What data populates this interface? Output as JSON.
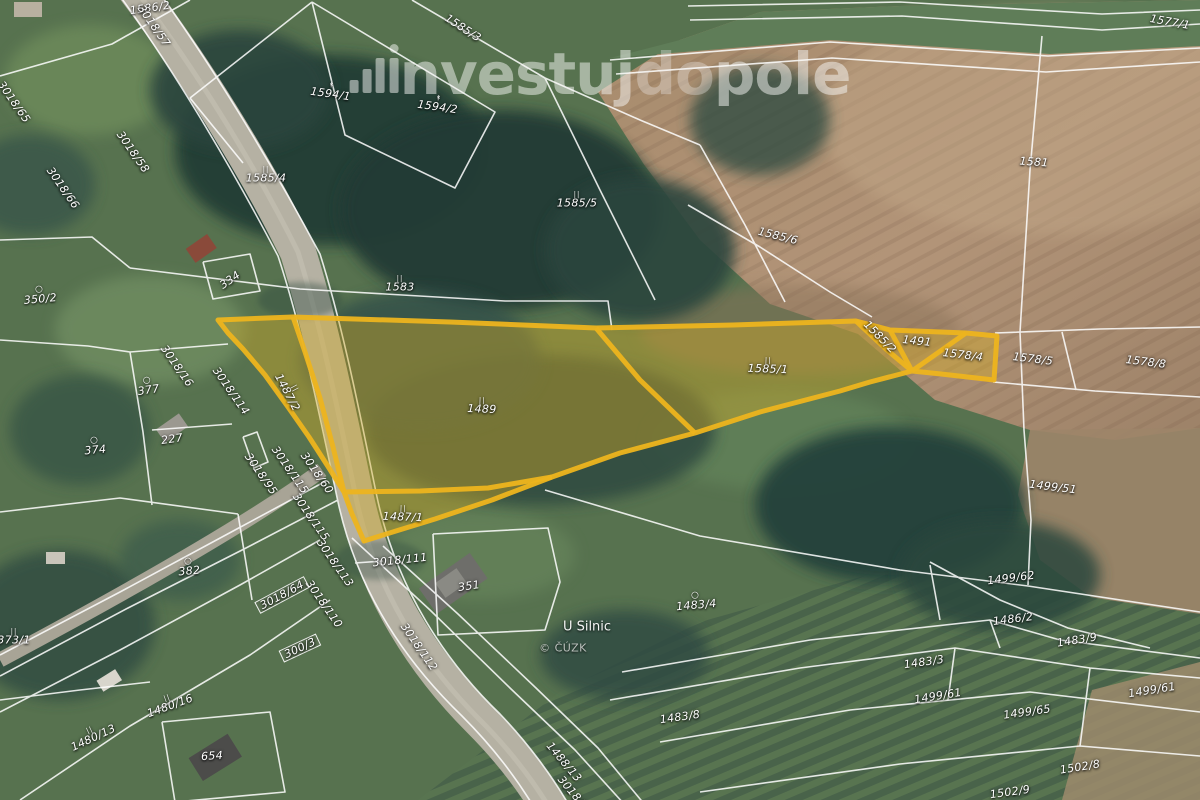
{
  "watermark": {
    "icon": "bar-chart-logo",
    "text_investuj": "nvestuj",
    "text_do": "do",
    "text_pole": "pole"
  },
  "map": {
    "place_label": "U Silnic",
    "copyright": "© ČÚZK",
    "highlight": {
      "color": "#edb41e",
      "parcels": [
        "1487/1",
        "1487/2",
        "1489",
        "1585/1",
        "1585/2",
        "1491",
        "1578/4"
      ]
    },
    "parcel_labels": [
      {
        "text": "1586/2",
        "x": 150,
        "y": 8,
        "rot": -8
      },
      {
        "text": "1585/3",
        "x": 463,
        "y": 28,
        "rot": 33
      },
      {
        "text": "1577/1",
        "x": 1170,
        "y": 22,
        "rot": 10
      },
      {
        "text": "1594/1",
        "x": 331,
        "y": 91,
        "rot": 8,
        "sym": "tree"
      },
      {
        "text": "1594/2",
        "x": 438,
        "y": 104,
        "rot": 8,
        "sym": "tree"
      },
      {
        "text": "3018/57",
        "x": 154,
        "y": 26,
        "rot": 55
      },
      {
        "text": "3018/58",
        "x": 133,
        "y": 152,
        "rot": 55
      },
      {
        "text": "3018/66",
        "x": 63,
        "y": 188,
        "rot": 55
      },
      {
        "text": "3018/65",
        "x": 14,
        "y": 102,
        "rot": 55
      },
      {
        "text": "1585/4",
        "x": 266,
        "y": 175,
        "rot": 0,
        "sym": "ii"
      },
      {
        "text": "1585/5",
        "x": 577,
        "y": 200,
        "rot": 0,
        "sym": "ii"
      },
      {
        "text": "1583",
        "x": 400,
        "y": 284,
        "rot": 0,
        "sym": "ii"
      },
      {
        "text": "1585/6",
        "x": 778,
        "y": 236,
        "rot": 14
      },
      {
        "text": "1581",
        "x": 1034,
        "y": 162,
        "rot": 4
      },
      {
        "text": "334",
        "x": 230,
        "y": 280,
        "rot": -35
      },
      {
        "text": "350/2",
        "x": 40,
        "y": 295,
        "rot": -5,
        "sym": "circle"
      },
      {
        "text": "377",
        "x": 148,
        "y": 386,
        "rot": -8,
        "sym": "circle"
      },
      {
        "text": "374",
        "x": 95,
        "y": 446,
        "rot": -5,
        "sym": "circle"
      },
      {
        "text": "227",
        "x": 172,
        "y": 439,
        "rot": -8
      },
      {
        "text": "382",
        "x": 189,
        "y": 567,
        "rot": -5,
        "sym": "circle"
      },
      {
        "text": "373/1",
        "x": 14,
        "y": 637,
        "rot": 0,
        "sym": "ii"
      },
      {
        "text": "3018/16",
        "x": 177,
        "y": 366,
        "rot": 55
      },
      {
        "text": "3018/114",
        "x": 231,
        "y": 391,
        "rot": 55
      },
      {
        "text": "1487/2",
        "x": 290,
        "y": 391,
        "rot": 62,
        "sym": "ii"
      },
      {
        "text": "3018/95",
        "x": 261,
        "y": 474,
        "rot": 55
      },
      {
        "text": "3018/115",
        "x": 290,
        "y": 470,
        "rot": 55
      },
      {
        "text": "3018/60",
        "x": 317,
        "y": 473,
        "rot": 55
      },
      {
        "text": "3018/115",
        "x": 311,
        "y": 517,
        "rot": 55
      },
      {
        "text": "3018/113",
        "x": 335,
        "y": 563,
        "rot": 55
      },
      {
        "text": "3018/110",
        "x": 324,
        "y": 604,
        "rot": 55
      },
      {
        "text": "3018/64",
        "x": 282,
        "y": 595,
        "rot": -28,
        "boxed": true
      },
      {
        "text": "300/3",
        "x": 300,
        "y": 648,
        "rot": -25,
        "boxed": true
      },
      {
        "text": "3018/111",
        "x": 400,
        "y": 560,
        "rot": -6
      },
      {
        "text": "3018/112",
        "x": 419,
        "y": 647,
        "rot": 55
      },
      {
        "text": "1489",
        "x": 482,
        "y": 406,
        "rot": 2,
        "sym": "ii"
      },
      {
        "text": "1487/1",
        "x": 403,
        "y": 514,
        "rot": 2,
        "sym": "ii"
      },
      {
        "text": "1585/1",
        "x": 768,
        "y": 366,
        "rot": 2,
        "sym": "ii"
      },
      {
        "text": "1585/2",
        "x": 880,
        "y": 337,
        "rot": 45
      },
      {
        "text": "1491",
        "x": 917,
        "y": 341,
        "rot": 6
      },
      {
        "text": "1578/4",
        "x": 963,
        "y": 355,
        "rot": 7
      },
      {
        "text": "1578/5",
        "x": 1033,
        "y": 359,
        "rot": 7
      },
      {
        "text": "1578/8",
        "x": 1146,
        "y": 362,
        "rot": 7
      },
      {
        "text": "1499/51",
        "x": 1053,
        "y": 487,
        "rot": 7
      },
      {
        "text": "1499/62",
        "x": 1011,
        "y": 578,
        "rot": -7
      },
      {
        "text": "1486/2",
        "x": 1013,
        "y": 619,
        "rot": -7
      },
      {
        "text": "1483/9",
        "x": 1077,
        "y": 640,
        "rot": -9
      },
      {
        "text": "1483/3",
        "x": 924,
        "y": 662,
        "rot": -8
      },
      {
        "text": "1499/61",
        "x": 938,
        "y": 696,
        "rot": -9
      },
      {
        "text": "1499/65",
        "x": 1027,
        "y": 712,
        "rot": -8
      },
      {
        "text": "1499/61",
        "x": 1152,
        "y": 690,
        "rot": -9
      },
      {
        "text": "1502/8",
        "x": 1080,
        "y": 767,
        "rot": -9
      },
      {
        "text": "1502/9",
        "x": 1010,
        "y": 792,
        "rot": -8
      },
      {
        "text": "1483/4",
        "x": 696,
        "y": 601,
        "rot": -5,
        "sym": "circle"
      },
      {
        "text": "1483/8",
        "x": 680,
        "y": 717,
        "rot": -8
      },
      {
        "text": "1488/13",
        "x": 564,
        "y": 762,
        "rot": 50
      },
      {
        "text": "3018/1",
        "x": 573,
        "y": 793,
        "rot": 50
      },
      {
        "text": "654",
        "x": 212,
        "y": 756,
        "rot": -3
      },
      {
        "text": "351",
        "x": 469,
        "y": 586,
        "rot": -8
      },
      {
        "text": "1480/13",
        "x": 92,
        "y": 735,
        "rot": -25,
        "sym": "ii"
      },
      {
        "text": "1480/16",
        "x": 169,
        "y": 703,
        "rot": -20,
        "sym": "ii"
      }
    ]
  }
}
